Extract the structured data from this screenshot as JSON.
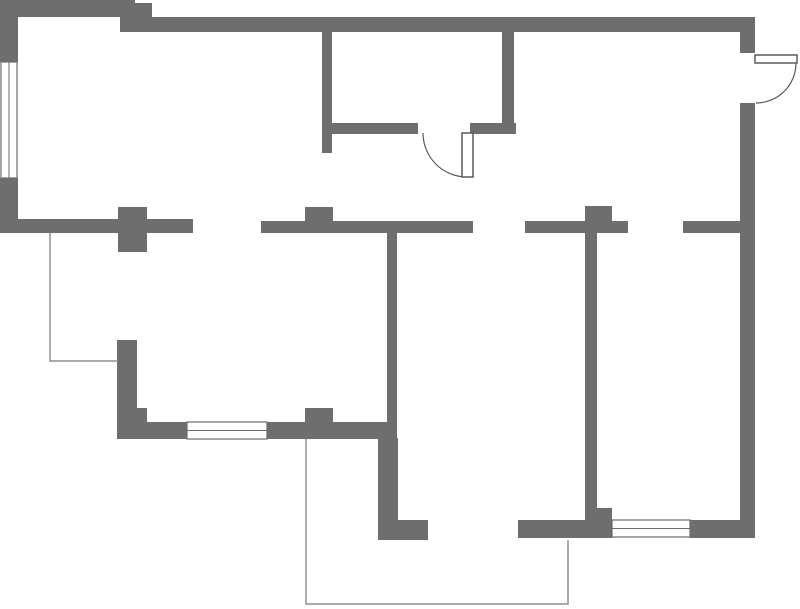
{
  "canvas": {
    "width": 800,
    "height": 609,
    "background": "#ffffff"
  },
  "colors": {
    "wall": "#6e6e6e",
    "thin_line": "#8f8f8f",
    "door_stroke": "#5a5a5a",
    "door_fill": "#ffffff",
    "window_border": "#6a6a6a",
    "window_fill": "#ffffff"
  },
  "walls": [
    {
      "name": "wall-top-left-exterior",
      "x": 0,
      "y": 0,
      "w": 135,
      "h": 17
    },
    {
      "name": "wall-top-step",
      "x": 133,
      "y": 3,
      "w": 19,
      "h": 29
    },
    {
      "name": "wall-top-band",
      "x": 120,
      "y": 17,
      "w": 635,
      "h": 15
    },
    {
      "name": "wall-left-upper",
      "x": 0,
      "y": 0,
      "w": 18,
      "h": 62
    },
    {
      "name": "wall-left-lower",
      "x": 0,
      "y": 178,
      "w": 18,
      "h": 55
    },
    {
      "name": "wall-hall-south-band",
      "x": 0,
      "y": 219,
      "w": 193,
      "h": 14
    },
    {
      "name": "pillar-hall",
      "x": 118,
      "y": 207,
      "w": 29,
      "h": 45
    },
    {
      "name": "wall-mid-band-a",
      "x": 261,
      "y": 221,
      "w": 212,
      "h": 12
    },
    {
      "name": "pillar-mid-a",
      "x": 305,
      "y": 207,
      "w": 28,
      "h": 16
    },
    {
      "name": "wall-mid-band-b",
      "x": 525,
      "y": 221,
      "w": 103,
      "h": 12
    },
    {
      "name": "pillar-mid-b",
      "x": 585,
      "y": 206,
      "w": 27,
      "h": 17
    },
    {
      "name": "wall-mid-band-c",
      "x": 683,
      "y": 221,
      "w": 57,
      "h": 12
    },
    {
      "name": "wall-right-top",
      "x": 740,
      "y": 17,
      "w": 15,
      "h": 36
    },
    {
      "name": "wall-right-main",
      "x": 740,
      "y": 103,
      "w": 15,
      "h": 435
    },
    {
      "name": "wall-wc-left",
      "x": 322,
      "y": 32,
      "w": 10,
      "h": 121
    },
    {
      "name": "wall-wc-south-left",
      "x": 322,
      "y": 123,
      "w": 96,
      "h": 11
    },
    {
      "name": "wall-wc-south-right",
      "x": 470,
      "y": 123,
      "w": 46,
      "h": 11
    },
    {
      "name": "wall-wc-right",
      "x": 502,
      "y": 32,
      "w": 12,
      "h": 101
    },
    {
      "name": "wall-center-vertical",
      "x": 387,
      "y": 223,
      "w": 10,
      "h": 199
    },
    {
      "name": "wall-bottomleft-vertical",
      "x": 117,
      "y": 340,
      "w": 20,
      "h": 83
    },
    {
      "name": "wall-bottomleft-step",
      "x": 137,
      "y": 408,
      "w": 10,
      "h": 15
    },
    {
      "name": "wall-south-band-1",
      "x": 117,
      "y": 422,
      "w": 70,
      "h": 17
    },
    {
      "name": "wall-south-band-2",
      "x": 267,
      "y": 422,
      "w": 130,
      "h": 17
    },
    {
      "name": "pillar-south",
      "x": 305,
      "y": 408,
      "w": 28,
      "h": 14
    },
    {
      "name": "wall-lower-vertical",
      "x": 378,
      "y": 438,
      "w": 20,
      "h": 102
    },
    {
      "name": "wall-lower-foot",
      "x": 396,
      "y": 520,
      "w": 32,
      "h": 20
    },
    {
      "name": "wall-south-band-3",
      "x": 518,
      "y": 520,
      "w": 94,
      "h": 18
    },
    {
      "name": "wall-bottomright-corner",
      "x": 585,
      "y": 508,
      "w": 27,
      "h": 30
    },
    {
      "name": "wall-bottomright-vertical",
      "x": 585,
      "y": 223,
      "w": 12,
      "h": 285
    },
    {
      "name": "wall-south-band-4",
      "x": 690,
      "y": 520,
      "w": 65,
      "h": 18
    }
  ],
  "windows": [
    {
      "name": "window-left",
      "x": 1,
      "y": 62,
      "w": 16,
      "h": 116,
      "orientation": "vertical"
    },
    {
      "name": "window-bottom-left",
      "x": 187,
      "y": 422,
      "w": 80,
      "h": 17,
      "orientation": "horizontal"
    },
    {
      "name": "window-bottom-right",
      "x": 612,
      "y": 520,
      "w": 78,
      "h": 17,
      "orientation": "horizontal"
    }
  ],
  "doors": [
    {
      "name": "door-interior",
      "leaf": {
        "x": 462,
        "y": 133,
        "w": 11,
        "h": 44
      },
      "arc": "M 423 133 A 44 44 0 0 0 467 177"
    },
    {
      "name": "door-entry",
      "leaf": {
        "x": 755,
        "y": 55,
        "w": 42,
        "h": 8
      },
      "arc": "M 796 63 A 40 40 0 0 1 756 103"
    }
  ],
  "annotation_lines": [
    {
      "name": "outline-open-area",
      "points": "50,233 50,361 118,361"
    },
    {
      "name": "outline-balcony",
      "points": "306,439 306,604 568,604 568,540"
    }
  ]
}
